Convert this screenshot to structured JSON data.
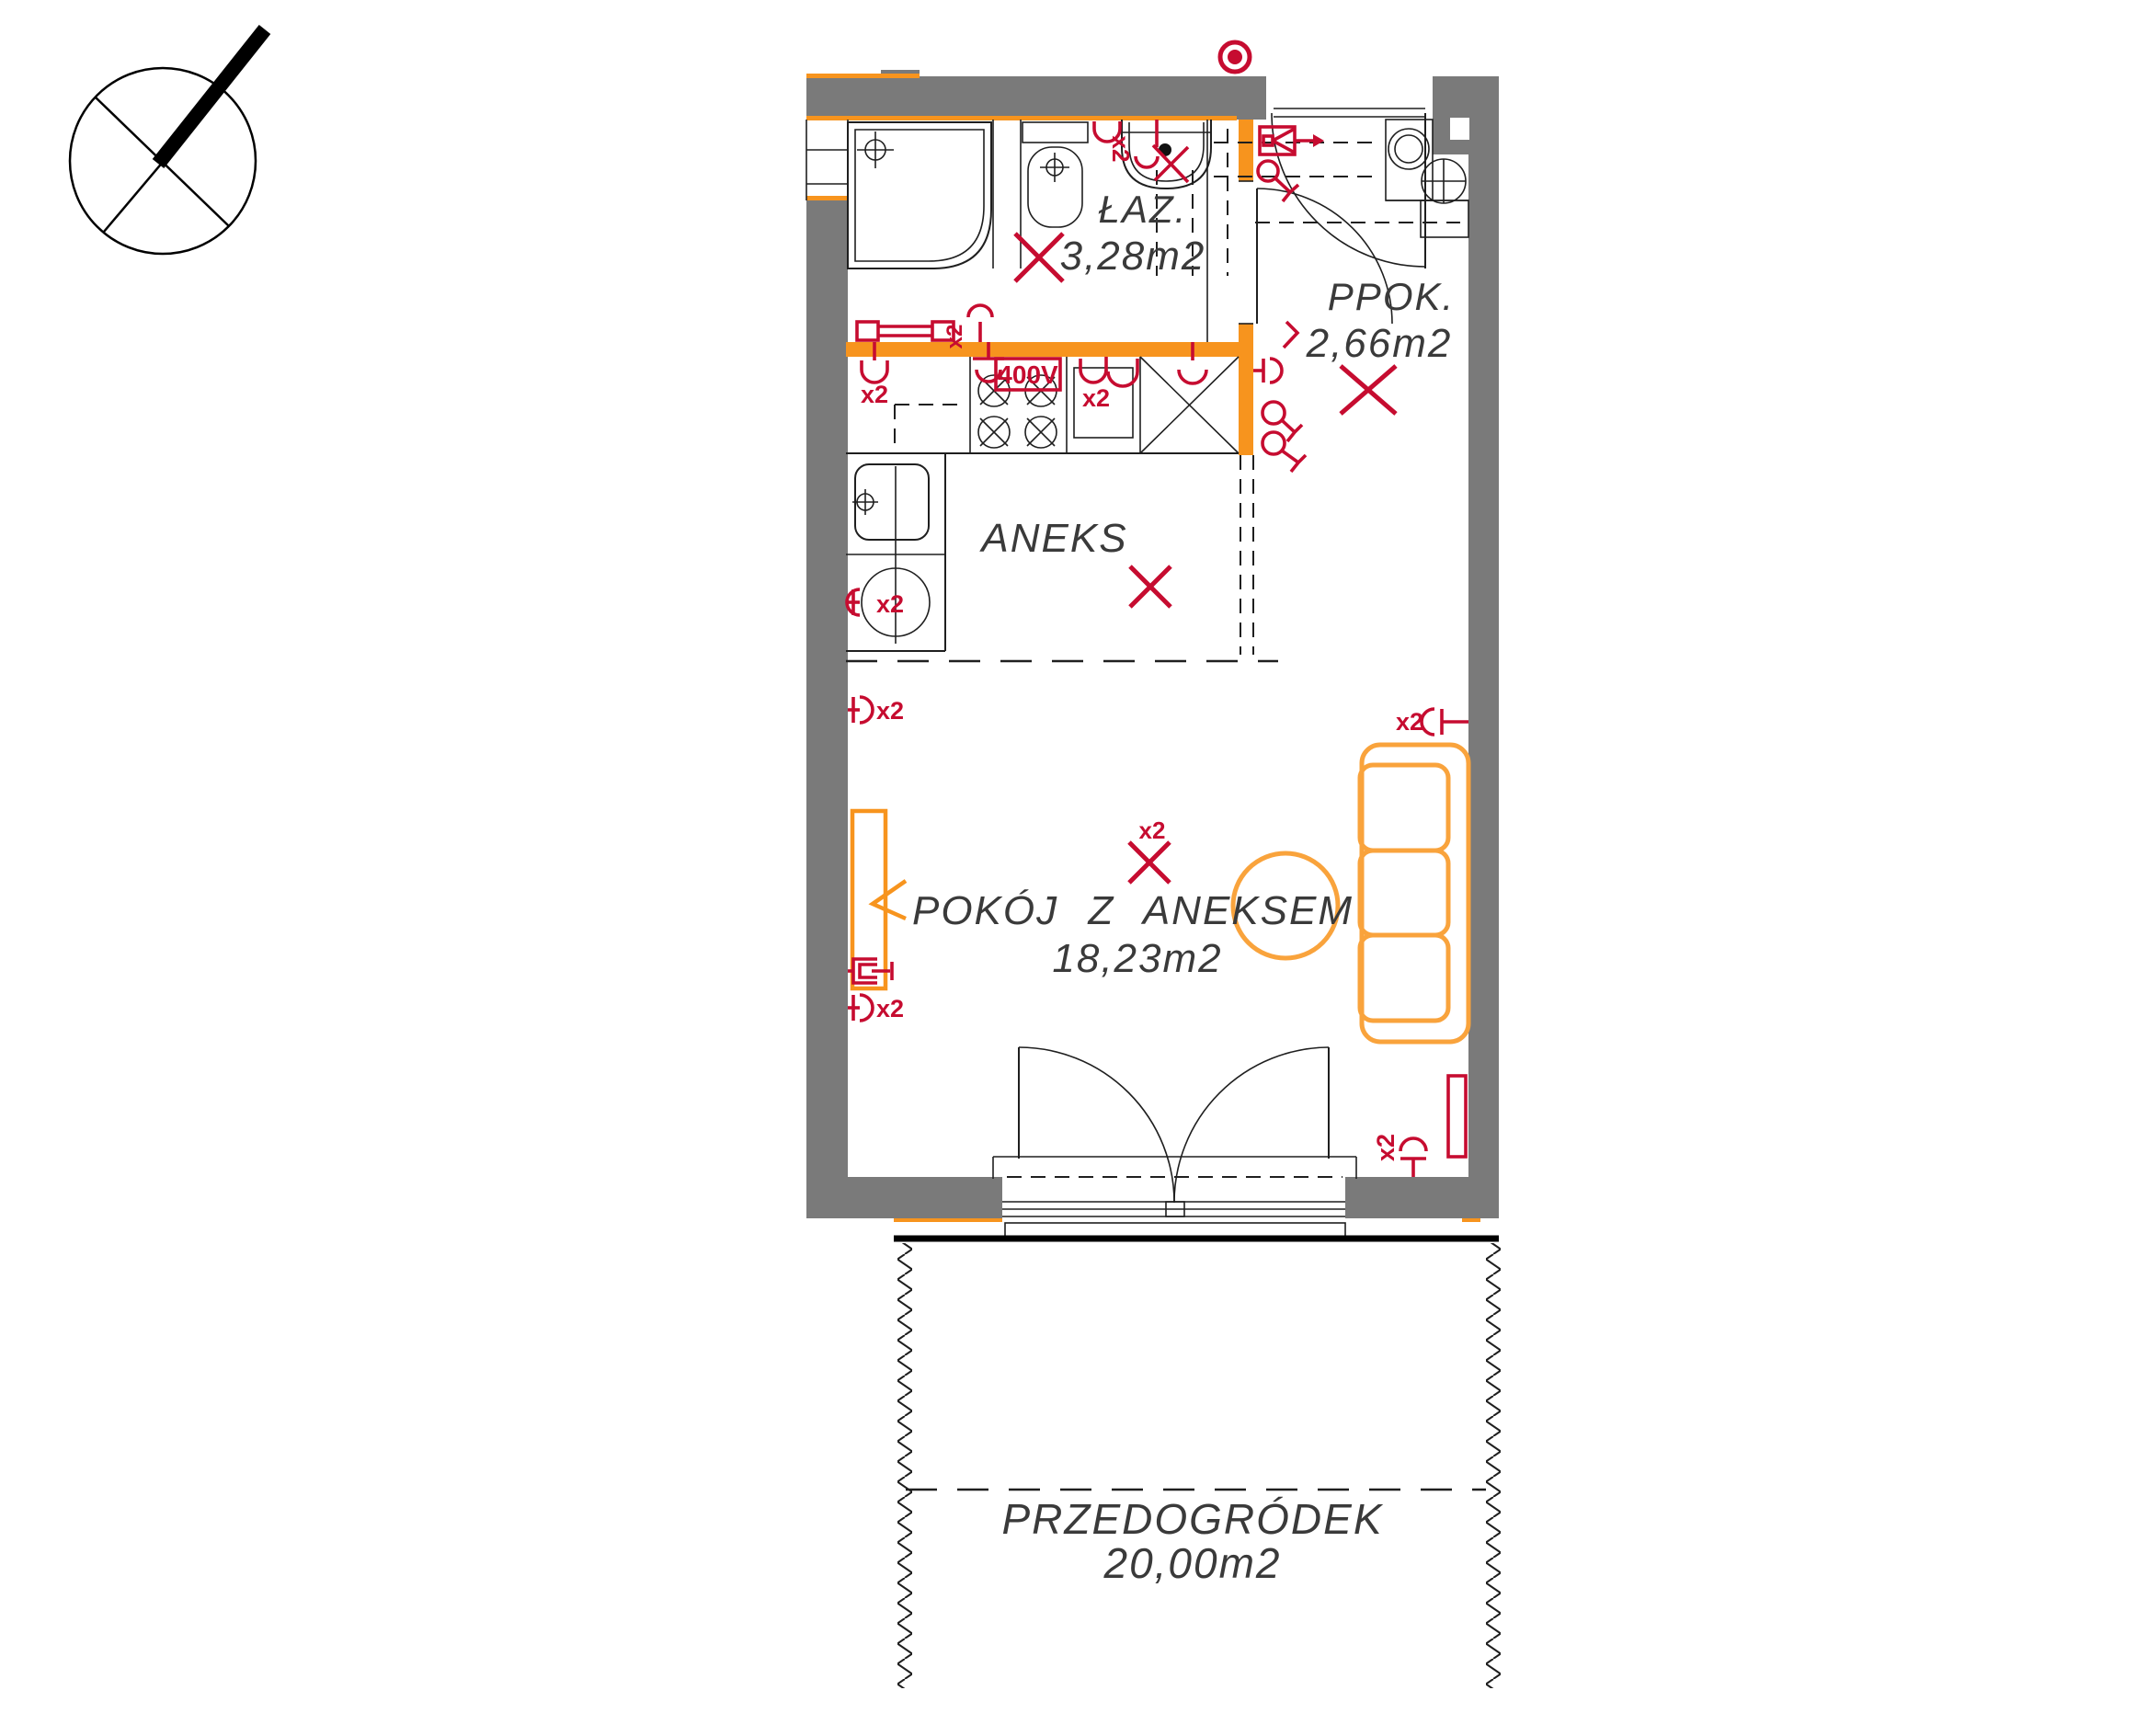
{
  "drawing": {
    "type": "apartment-floor-plan",
    "rooms": {
      "bathroom": {
        "name": "ŁAZ.",
        "area": "3,28m2"
      },
      "hallway": {
        "name": "PPOK.",
        "area": "2,66m2"
      },
      "kitchen": {
        "name": "ANEKS"
      },
      "living": {
        "name": "POKÓJ Z ANEKSEM",
        "area": "18,23m2"
      },
      "garden": {
        "name": "PRZEDOGRÓDEK",
        "area": "20,00m2"
      }
    },
    "electrical": {
      "double_socket_label": "x2",
      "stove_power_label": "400V"
    },
    "colors": {
      "wall_gray": "#7a7a7a",
      "accent_orange": "#f7941e",
      "furniture_orange": "#f9a33c",
      "electrical_red": "#c60c30",
      "line_black": "#1f1f1f"
    }
  }
}
